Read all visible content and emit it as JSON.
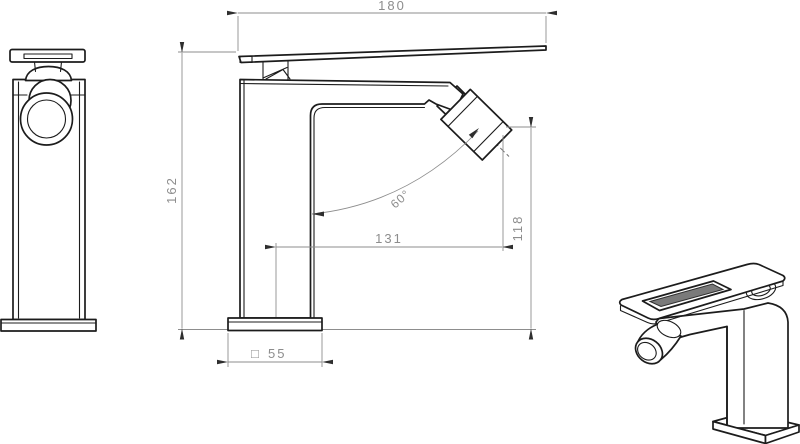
{
  "drawing": {
    "dimensions": {
      "spout_length": "180",
      "total_height": "162",
      "spout_reach": "131",
      "outlet_height": "118",
      "spray_angle": "60°",
      "base_square_symbol": "□",
      "base_size": "55"
    },
    "colors": {
      "outline": "#1c1c1c",
      "dimension_lines": "#8d8d8d",
      "arrowheads": "#2e2e2e",
      "slot_fill": "#7a7a7a",
      "background": "#ffffff"
    }
  }
}
